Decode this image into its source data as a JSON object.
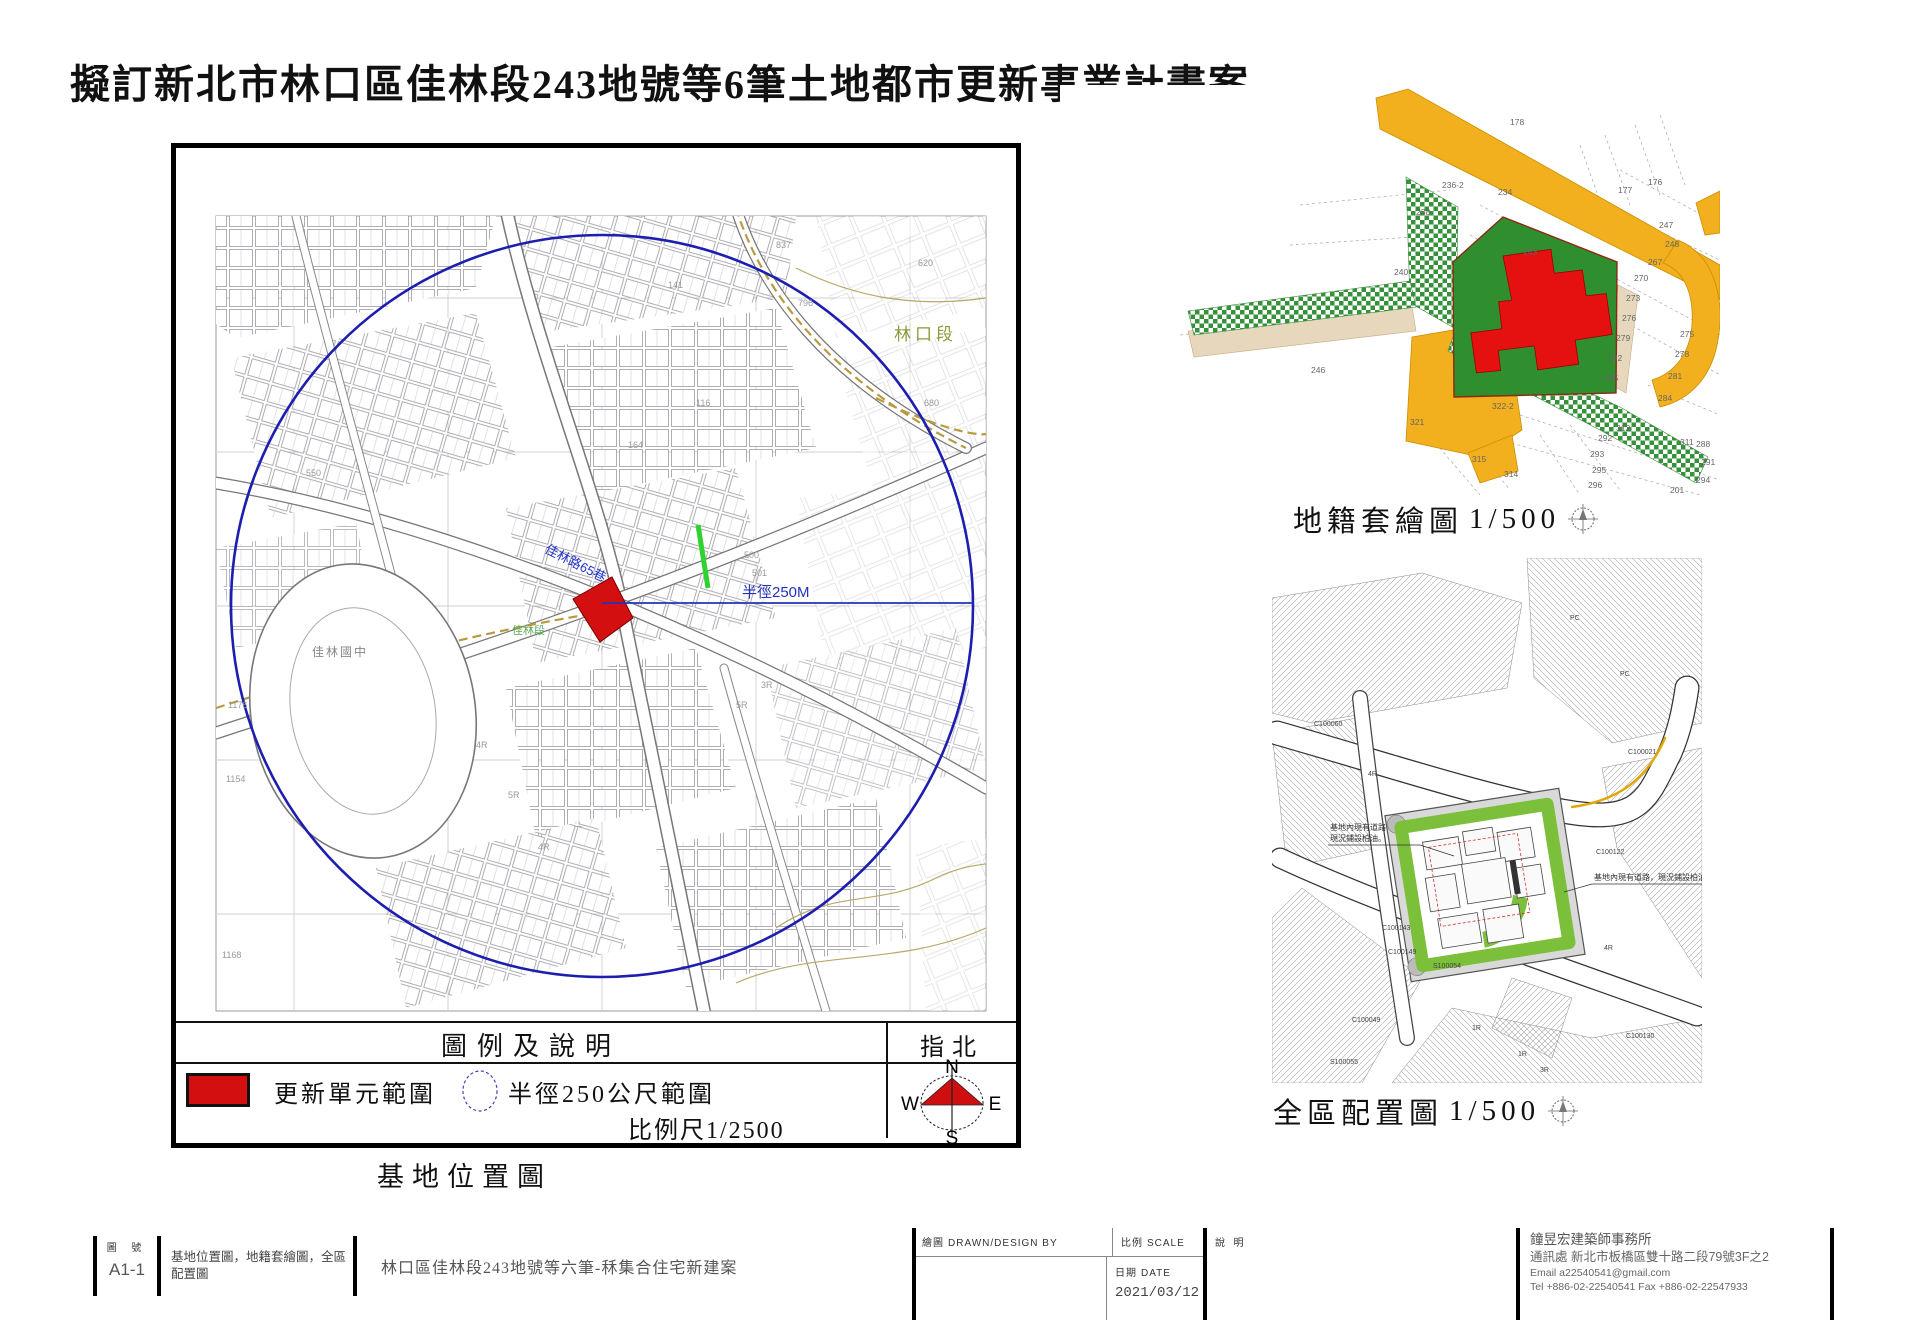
{
  "page": {
    "title": "擬訂新北市林口區佳林段243地號等6筆土地都市更新事業計畫案"
  },
  "colors": {
    "update_red": "#d40f0f",
    "circle_blue": "#1d1db0",
    "road_orange": "#f2b01e",
    "parcel_green": "#2f8f2f",
    "planting_green": "#7cbf3a",
    "olive_road": "#b89b3e",
    "compass_red": "#cf0f0f",
    "yellow_line": "#e3a800"
  },
  "site_map": {
    "caption": "基地位置圖",
    "legend": {
      "header": "圖例及說明",
      "item_update": "更新單元範圍",
      "item_radius": "半徑250公尺範圍",
      "scale": "比例尺1/2500",
      "north_title": "指北",
      "compass": {
        "n": "N",
        "e": "E",
        "s": "S",
        "w": "W"
      }
    },
    "labels": {
      "radius_line": "半徑250M",
      "street_blue": "佳林路65巷",
      "district": "林口段",
      "school": "佳林國中",
      "segment": "佳林段"
    },
    "numbers": [
      {
        "t": "1176",
        "x": 52,
        "y": 560
      },
      {
        "t": "1154",
        "x": 50,
        "y": 634
      },
      {
        "t": "1168",
        "x": 46,
        "y": 810
      },
      {
        "t": "550",
        "x": 130,
        "y": 328
      },
      {
        "t": "837",
        "x": 600,
        "y": 100
      },
      {
        "t": "796",
        "x": 622,
        "y": 158
      },
      {
        "t": "141",
        "x": 492,
        "y": 140
      },
      {
        "t": "116",
        "x": 520,
        "y": 258
      },
      {
        "t": "164",
        "x": 452,
        "y": 300
      },
      {
        "t": "500",
        "x": 568,
        "y": 410
      },
      {
        "t": "501",
        "x": 576,
        "y": 428
      },
      {
        "t": "620",
        "x": 742,
        "y": 118
      },
      {
        "t": "680",
        "x": 748,
        "y": 258
      },
      {
        "t": "4R",
        "x": 300,
        "y": 600
      },
      {
        "t": "5R",
        "x": 332,
        "y": 650
      },
      {
        "t": "4R",
        "x": 362,
        "y": 702
      },
      {
        "t": "5R",
        "x": 560,
        "y": 560
      },
      {
        "t": "3R",
        "x": 585,
        "y": 540
      }
    ]
  },
  "cadastral": {
    "caption": "地籍套繪圖",
    "scale": "1/500",
    "parcels": [
      {
        "t": "178",
        "x": 450,
        "y": 40
      },
      {
        "t": "176",
        "x": 588,
        "y": 100
      },
      {
        "t": "177",
        "x": 558,
        "y": 108
      },
      {
        "t": "236-2",
        "x": 382,
        "y": 103
      },
      {
        "t": "234",
        "x": 438,
        "y": 110
      },
      {
        "t": "238",
        "x": 356,
        "y": 130
      },
      {
        "t": "240",
        "x": 334,
        "y": 190
      },
      {
        "t": "246",
        "x": 251,
        "y": 288
      },
      {
        "t": "243",
        "x": 463,
        "y": 170
      },
      {
        "t": "247",
        "x": 599,
        "y": 143
      },
      {
        "t": "248",
        "x": 605,
        "y": 162
      },
      {
        "t": "267",
        "x": 588,
        "y": 180
      },
      {
        "t": "270",
        "x": 574,
        "y": 196
      },
      {
        "t": "273",
        "x": 566,
        "y": 216
      },
      {
        "t": "276",
        "x": 562,
        "y": 236
      },
      {
        "t": "279",
        "x": 556,
        "y": 256
      },
      {
        "t": "282",
        "x": 548,
        "y": 276
      },
      {
        "t": "285",
        "x": 544,
        "y": 296
      },
      {
        "t": "275",
        "x": 620,
        "y": 252
      },
      {
        "t": "278",
        "x": 615,
        "y": 272
      },
      {
        "t": "281",
        "x": 608,
        "y": 294
      },
      {
        "t": "284",
        "x": 598,
        "y": 316
      },
      {
        "t": "311",
        "x": 620,
        "y": 360
      },
      {
        "t": "312",
        "x": 556,
        "y": 346
      },
      {
        "t": "322-2",
        "x": 432,
        "y": 324
      },
      {
        "t": "321",
        "x": 350,
        "y": 340
      },
      {
        "t": "315",
        "x": 412,
        "y": 377
      },
      {
        "t": "314",
        "x": 444,
        "y": 392
      },
      {
        "t": "292",
        "x": 538,
        "y": 356
      },
      {
        "t": "293",
        "x": 530,
        "y": 372
      },
      {
        "t": "295",
        "x": 532,
        "y": 388
      },
      {
        "t": "296",
        "x": 528,
        "y": 403
      },
      {
        "t": "288",
        "x": 636,
        "y": 362
      },
      {
        "t": "291",
        "x": 641,
        "y": 380
      },
      {
        "t": "294",
        "x": 636,
        "y": 398
      },
      {
        "t": "201",
        "x": 610,
        "y": 408
      }
    ]
  },
  "site_plan": {
    "caption": "全區配置圖",
    "scale": "1/500",
    "annotation_left_1": "基地內現有道路",
    "annotation_left_2": "現況鋪設柏油。",
    "annotation_right": "基地內現有道路，現況鋪設柏油。",
    "points": [
      {
        "t": "C100060",
        "x": 42,
        "y": 168
      },
      {
        "t": "C100021",
        "x": 356,
        "y": 196
      },
      {
        "t": "C100122",
        "x": 324,
        "y": 296
      },
      {
        "t": "C100143",
        "x": 110,
        "y": 372
      },
      {
        "t": "C100149",
        "x": 116,
        "y": 396
      },
      {
        "t": "S100054",
        "x": 161,
        "y": 410
      },
      {
        "t": "C100049",
        "x": 80,
        "y": 464
      },
      {
        "t": "S100055",
        "x": 58,
        "y": 506
      },
      {
        "t": "C100130",
        "x": 354,
        "y": 480
      },
      {
        "t": "PC",
        "x": 348,
        "y": 118
      },
      {
        "t": "PC",
        "x": 298,
        "y": 62
      },
      {
        "t": "1R",
        "x": 200,
        "y": 472
      },
      {
        "t": "4R",
        "x": 332,
        "y": 392
      },
      {
        "t": "3R",
        "x": 268,
        "y": 514
      },
      {
        "t": "1R",
        "x": 246,
        "y": 498
      },
      {
        "t": "4R",
        "x": 96,
        "y": 218
      }
    ]
  },
  "title_block": {
    "sheet_no_label": "圖 號",
    "sheet_no": "A1-1",
    "drawing_names": "基地位置圖，地籍套繪圖，全區配置圖",
    "project_name": "林口區佳林段243地號等六筆-秝集合住宅新建案",
    "drawn_label": "繪圖",
    "drawn_label_en": "DRAWN/DESIGN BY",
    "scale_label": "比例",
    "scale_label_en": "SCALE",
    "date_label": "日期",
    "date_label_en": "DATE",
    "date_value": "2021/03/12",
    "note_label": "說 明",
    "firm": {
      "name": "鐘昱宏建築師事務所",
      "address": "通訊處 新北市板橋區雙十路二段79號3F之2",
      "email": "Email a22540541@gmail.com",
      "tel": "Tel +886-02-22540541 Fax +886-02-22547933"
    }
  }
}
